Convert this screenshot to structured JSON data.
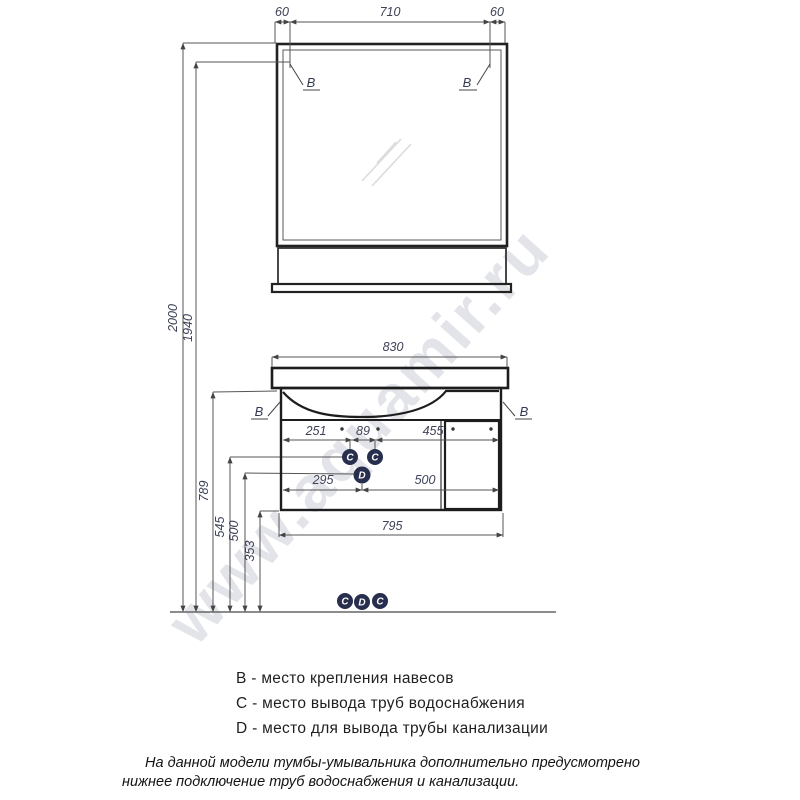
{
  "watermark": "www.aquamir.ru",
  "mirror": {
    "dim_left": "60",
    "dim_center": "710",
    "dim_right": "60",
    "hook_label": "B"
  },
  "heights": {
    "total": "2000",
    "hooks": "1940",
    "counter_underside": "789",
    "water_supply": "545",
    "drain": "500",
    "cabinet_bottom": "353"
  },
  "cabinet": {
    "width_top": "830",
    "width_bottom": "795",
    "row1": {
      "left": "251",
      "center": "89",
      "right": "455"
    },
    "row2": {
      "left": "295",
      "right": "500"
    },
    "hook_label": "B",
    "ports": {
      "supply": "C",
      "drain": "D"
    }
  },
  "floor_ports": {
    "left": "C",
    "center": "D",
    "right": "C"
  },
  "legend": {
    "lines": [
      "B - место крепления навесов",
      "C - место вывода труб водоснабжения",
      "D - место для вывода трубы канализации"
    ]
  },
  "note": {
    "line1": "На данной модели тумбы-умывальника дополнительно предусмотрено",
    "line2": "нижнее подключение труб водоснабжения и канализации."
  },
  "colors": {
    "line": "#222222",
    "thin": "#5a5a5a",
    "dim_text": "#3d4257",
    "port_fill": "#272e4e",
    "watermark": "#c7cbd5"
  }
}
